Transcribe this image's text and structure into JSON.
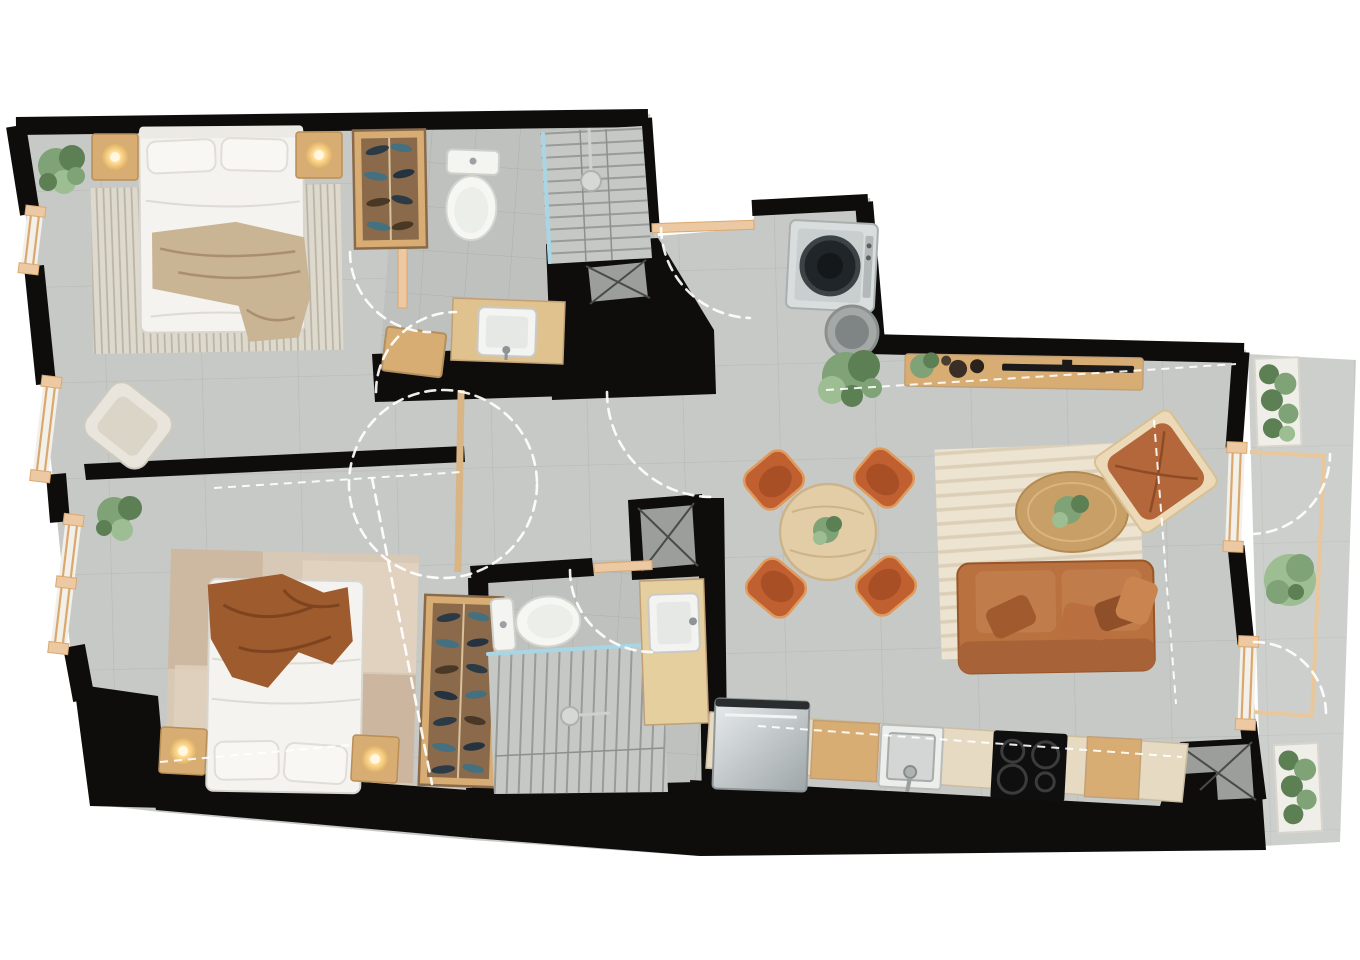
{
  "scene": {
    "type": "apartment-floor-plan-top-view",
    "style": "photorealistic 2D rendering, black walls on white background, gray tiled floors, warm wood and terracotta furniture"
  },
  "colors": {
    "wall": "#0e0d0c",
    "floor": "#c7c9c6",
    "floor_bath": "#bec1bd",
    "balcony_floor": "#cdcfcc",
    "tile_line": "#b8bab7",
    "wood": "#d8ad74",
    "wood_dark": "#8a6a4a",
    "wood_pale": "#e8c79b",
    "counter": "#e7dac2",
    "bed_white": "#f4f3ef",
    "throw_beige": "#c9b493",
    "blanket_brown": "#9e5b2d",
    "rug_cream": "#ded9cd",
    "rug_beige": "#d8c8b6",
    "rug_living": "#ece3d0",
    "terracotta": "#b9713f",
    "terracotta_dark": "#985527",
    "cream_chair": "#e9e5dc",
    "plant": "#7fa376",
    "plant_dark": "#5c7f54",
    "plant_light": "#9dbd92",
    "glass": "#a9d6e5",
    "shaft": "#9c9e9b",
    "shaft_line": "#4a4a4a",
    "stainless": "#d6dadb",
    "appliance_dark": "#16181a",
    "dash": "#ffffff",
    "window_frame": "#d9a86f",
    "window_band": "#f3efe9",
    "sill": "#ecc9a2",
    "railing": "#e9c79a"
  },
  "rooms": [
    {
      "id": "bedroom-1",
      "label": "Bedroom 1",
      "position": "top-left",
      "furniture": [
        "double-bed-white",
        "headboard",
        "pillows",
        "throw-blanket-beige",
        "striped-rug",
        "nightstand-with-lamp-left",
        "nightstand-with-lamp-right",
        "potted-plant",
        "open-wardrobe-shelves",
        "armchair-cream",
        "window-wall-left"
      ]
    },
    {
      "id": "bathroom-1",
      "label": "Bathroom 1",
      "position": "top-center",
      "furniture": [
        "toilet",
        "walk-in-shower-with-glass",
        "shower-head",
        "vanity-sink-on-wood-counter",
        "service-shaft",
        "wood-door-leaf"
      ]
    },
    {
      "id": "laundry-nook",
      "label": "Laundry nook",
      "position": "top-middle",
      "furniture": [
        "washing-machine-front-load",
        "laundry-basket"
      ]
    },
    {
      "id": "hallway",
      "label": "Hallway",
      "position": "center-left",
      "furniture": [
        "door-swing-arcs",
        "sliding-door-track",
        "wood-thresholds"
      ]
    },
    {
      "id": "bedroom-2",
      "label": "Bedroom 2",
      "position": "bottom-left",
      "furniture": [
        "double-bed-white",
        "blanket-brown",
        "patchwork-rug",
        "nightstand-with-lamp-left",
        "nightstand-with-lamp-right",
        "potted-plant",
        "shoe-wardrobe-shelves",
        "window-wall-left"
      ]
    },
    {
      "id": "bathroom-2",
      "label": "Bathroom 2",
      "position": "bottom-center",
      "furniture": [
        "toilet",
        "walk-in-shower-with-glass",
        "shower-head",
        "vanity-sink-on-wood-counter",
        "service-shaft"
      ]
    },
    {
      "id": "living-dining-kitchen",
      "label": "Living / Dining / Kitchen",
      "position": "right",
      "furniture": [
        "sideboard-with-tv",
        "decor-bowls",
        "monstera-plant",
        "small-plant",
        "round-dining-table",
        "dining-chair x4",
        "table-centerpiece-plant",
        "living-rug",
        "oval-coffee-table",
        "coffee-table-plant",
        "sofa-terracotta-with-pillows",
        "leather-lounge-chair",
        "fridge-stainless",
        "kitchen-cabinet-wood x2",
        "kitchen-sink",
        "cooktop-4-burners",
        "kitchen-counter-run",
        "service-shaft-l-shaped"
      ]
    },
    {
      "id": "balcony",
      "label": "Balcony",
      "position": "right-edge",
      "furniture": [
        "planter-box-top",
        "planter-box-bottom",
        "round-bush",
        "railing",
        "door-swing-arcs"
      ]
    }
  ]
}
